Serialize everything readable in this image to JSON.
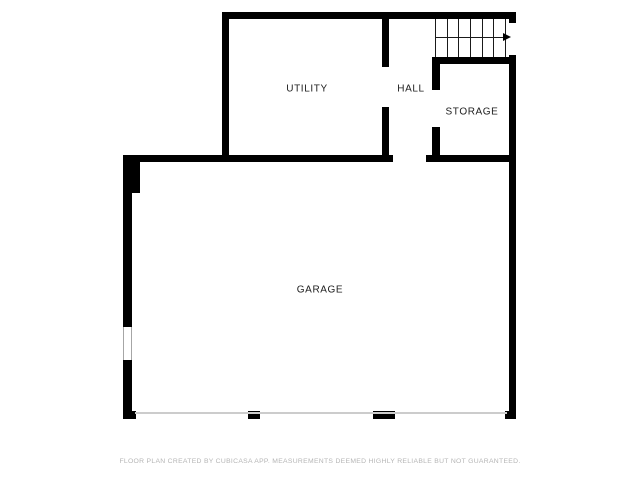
{
  "rooms": [
    {
      "name": "utility",
      "label": "UTILITY",
      "cx": 307,
      "cy": 89
    },
    {
      "name": "hall",
      "label": "HALL",
      "cx": 411,
      "cy": 89
    },
    {
      "name": "storage",
      "label": "STORAGE",
      "cx": 472,
      "cy": 112
    },
    {
      "name": "garage",
      "label": "GARAGE",
      "cx": 320,
      "cy": 290
    }
  ],
  "disclaimer": {
    "text": "FLOOR PLAN CREATED BY CUBICASA APP. MEASUREMENTS DEEMED HIGHLY RELIABLE BUT NOT GUARANTEED."
  },
  "icons": [
    {
      "name": "stairs-direction-arrow-icon",
      "glyph": "→"
    }
  ],
  "colors": {
    "background": "#ffffff",
    "wall": "#000000",
    "room_label": "#1c1c1c",
    "disclaimer_text": "#b5b5b5",
    "stair_line": "#1a1a1a",
    "garage_door_line": "#cccccc",
    "window_edge": "#a6a6a6"
  },
  "floorplan": {
    "canvas": {
      "width": 640,
      "height": 480
    },
    "walls": [
      {
        "name": "top",
        "x": 222,
        "y": 12,
        "w": 294,
        "h": 7
      },
      {
        "name": "utility-left",
        "x": 222,
        "y": 12,
        "w": 7,
        "h": 145
      },
      {
        "name": "right-upper-stub",
        "x": 509,
        "y": 12,
        "w": 7,
        "h": 11
      },
      {
        "name": "right-main",
        "x": 509,
        "y": 55,
        "w": 7,
        "h": 363
      },
      {
        "name": "utility-hall-divider-upper",
        "x": 382,
        "y": 19,
        "w": 7,
        "h": 48
      },
      {
        "name": "utility-hall-divider-lower",
        "x": 382,
        "y": 107,
        "w": 7,
        "h": 55
      },
      {
        "name": "storage-top",
        "x": 432,
        "y": 57,
        "w": 84,
        "h": 7
      },
      {
        "name": "storage-left-upper",
        "x": 432,
        "y": 64,
        "w": 8,
        "h": 26
      },
      {
        "name": "storage-left-lower",
        "x": 432,
        "y": 127,
        "w": 8,
        "h": 35
      },
      {
        "name": "garage-top",
        "x": 123,
        "y": 155,
        "w": 270,
        "h": 7
      },
      {
        "name": "hall-storage-bottom",
        "x": 426,
        "y": 155,
        "w": 90,
        "h": 7
      },
      {
        "name": "garage-left-entry-stub",
        "x": 123,
        "y": 162,
        "w": 17,
        "h": 31
      },
      {
        "name": "garage-left-upper",
        "x": 123,
        "y": 162,
        "w": 9,
        "h": 165
      },
      {
        "name": "garage-left-lower",
        "x": 123,
        "y": 360,
        "w": 9,
        "h": 58
      },
      {
        "name": "garage-bottom-left-corner",
        "x": 123,
        "y": 411,
        "w": 13,
        "h": 8
      },
      {
        "name": "garage-bottom-pier-1",
        "x": 248,
        "y": 411,
        "w": 12,
        "h": 8
      },
      {
        "name": "garage-bottom-pier-2",
        "x": 373,
        "y": 411,
        "w": 22,
        "h": 8
      },
      {
        "name": "garage-bottom-right-corner",
        "x": 505,
        "y": 411,
        "w": 11,
        "h": 8
      }
    ],
    "windows": [
      {
        "name": "garage-left-window",
        "x": 123,
        "y": 327,
        "w": 9,
        "h": 33
      }
    ],
    "garage_door_line": {
      "x": 135,
      "y": 412,
      "w": 372,
      "h": 2
    },
    "stairs": {
      "x": 435,
      "y": 19,
      "w": 74,
      "h": 38,
      "tread_count": 7,
      "tread_span": 70,
      "arrow_y": 37,
      "arrow_x1": 436,
      "arrow_x2": 503
    }
  }
}
